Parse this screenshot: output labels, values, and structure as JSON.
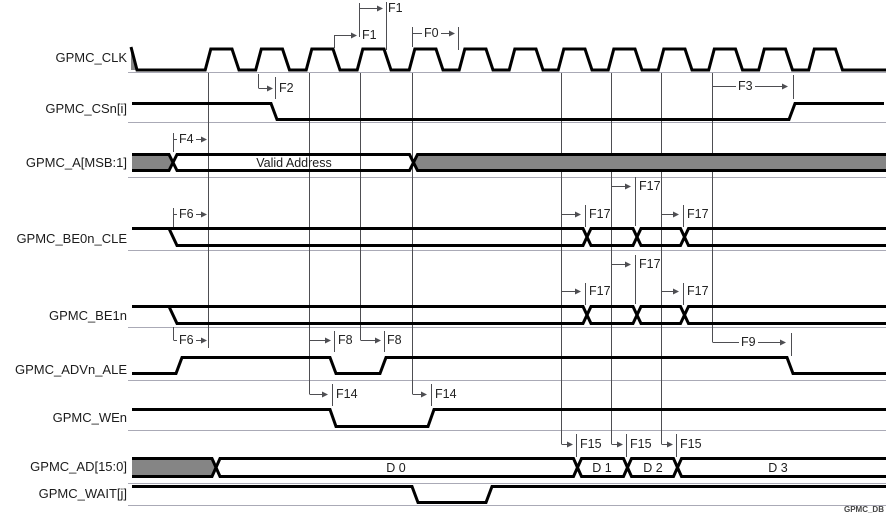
{
  "watermark": "GPMC_DB",
  "signals": [
    {
      "name": "GPMC_CLK",
      "type": "clock"
    },
    {
      "name": "GPMC_CSn[i]",
      "type": "digital"
    },
    {
      "name": "GPMC_A[MSB:1]",
      "type": "bus",
      "values": [
        "Valid Address"
      ]
    },
    {
      "name": "GPMC_BE0n_CLE",
      "type": "bus"
    },
    {
      "name": "GPMC_BE1n",
      "type": "bus"
    },
    {
      "name": "GPMC_ADVn_ALE",
      "type": "digital"
    },
    {
      "name": "GPMC_WEn",
      "type": "digital"
    },
    {
      "name": "GPMC_AD[15:0]",
      "type": "bus",
      "values": [
        "D 0",
        "D 1",
        "D 2",
        "D 3"
      ]
    },
    {
      "name": "GPMC_WAIT[j]",
      "type": "digital"
    }
  ],
  "annotations": [
    {
      "id": "f1-clk-high-time",
      "label": "F1"
    },
    {
      "id": "f1-clk-low-time",
      "label": "F1"
    },
    {
      "id": "f0-clk-cycle",
      "label": "F0"
    },
    {
      "id": "f2-csn-fall",
      "label": "F2"
    },
    {
      "id": "f3-csn-rise",
      "label": "F3"
    },
    {
      "id": "f4-addr-valid",
      "label": "F4"
    },
    {
      "id": "f6-be0n-fall",
      "label": "F6"
    },
    {
      "id": "f17-be0n-mid",
      "label": "F17"
    },
    {
      "id": "f17-be0n-left",
      "label": "F17"
    },
    {
      "id": "f17-be0n-right",
      "label": "F17"
    },
    {
      "id": "f17-be1n-mid",
      "label": "F17"
    },
    {
      "id": "f17-be1n-left",
      "label": "F17"
    },
    {
      "id": "f17-be1n-right",
      "label": "F17"
    },
    {
      "id": "f6-be1n-fall",
      "label": "F6"
    },
    {
      "id": "f8-advn-fall",
      "label": "F8"
    },
    {
      "id": "f8-advn-rise",
      "label": "F8"
    },
    {
      "id": "f9-advn-end",
      "label": "F9"
    },
    {
      "id": "f14-wen-fall",
      "label": "F14"
    },
    {
      "id": "f14-wen-rise",
      "label": "F14"
    },
    {
      "id": "f15-d1",
      "label": "F15"
    },
    {
      "id": "f15-d2",
      "label": "F15"
    },
    {
      "id": "f15-d3",
      "label": "F15"
    }
  ],
  "colors": {
    "signal": "#000000",
    "bus_fill": "#858585",
    "annotation": "#4e4e52",
    "separator": "#aaaab6",
    "text": "#1c1c1c",
    "background": "#ffffff"
  }
}
